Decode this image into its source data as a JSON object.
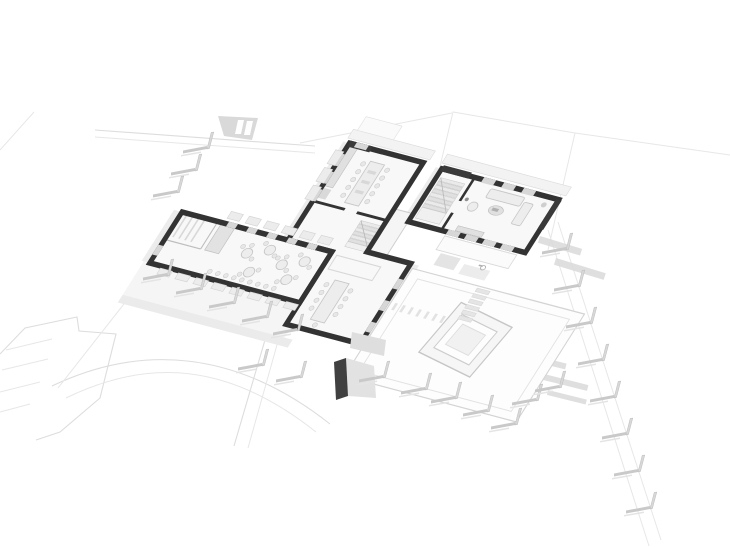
{
  "scene": {
    "type": "axonometric-cutaway-floor-plan",
    "style": "monochrome architectural 3D render, white background, dark cut walls, light gray site context",
    "wings": [
      {
        "id": "cafe-wing",
        "position": "left",
        "contents": [
          "storage room with vertical shelving",
          "tall cabinet",
          "six round tables with chairs",
          "chair row along window wall",
          "window sill boxes"
        ]
      },
      {
        "id": "kitchen-wing",
        "position": "center",
        "contents": [
          "kitchen counter",
          "long dining table with ten chairs",
          "interior staircase",
          "lower dining room with long table",
          "area rug"
        ]
      },
      {
        "id": "living-wing",
        "position": "right",
        "contents": [
          "staircase with landing",
          "sofa",
          "side sofa",
          "armchair",
          "coffee table",
          "sideboard",
          "potted plant"
        ]
      }
    ],
    "site": {
      "courtyard": "large square plaza with rotated nested-square planter",
      "stepping_stones": 6,
      "paver_ticks": 7,
      "fence_posts": 25,
      "parking": "angled parking lot with four stall lines, bottom left",
      "road": "curved road arc at bottom",
      "paths": "faint straight footpaths and plot boundary lines",
      "sheds": 2,
      "ramp": "small gray ramp on upper-left path"
    }
  },
  "colors": {
    "background": "#ffffff",
    "wall": "#333333",
    "wall_deep": "#3a3a3a",
    "floor": "#f8f8f8",
    "glass": "#d7d7d7",
    "post": "#c9c9c9",
    "post_stem": "#d8d8d8",
    "post_shadow": "#e4e4e4",
    "shed_dark": "#404040",
    "shed_gray": "#e2e2e2",
    "site_line": "#dddddd",
    "furniture": "#ededed"
  }
}
